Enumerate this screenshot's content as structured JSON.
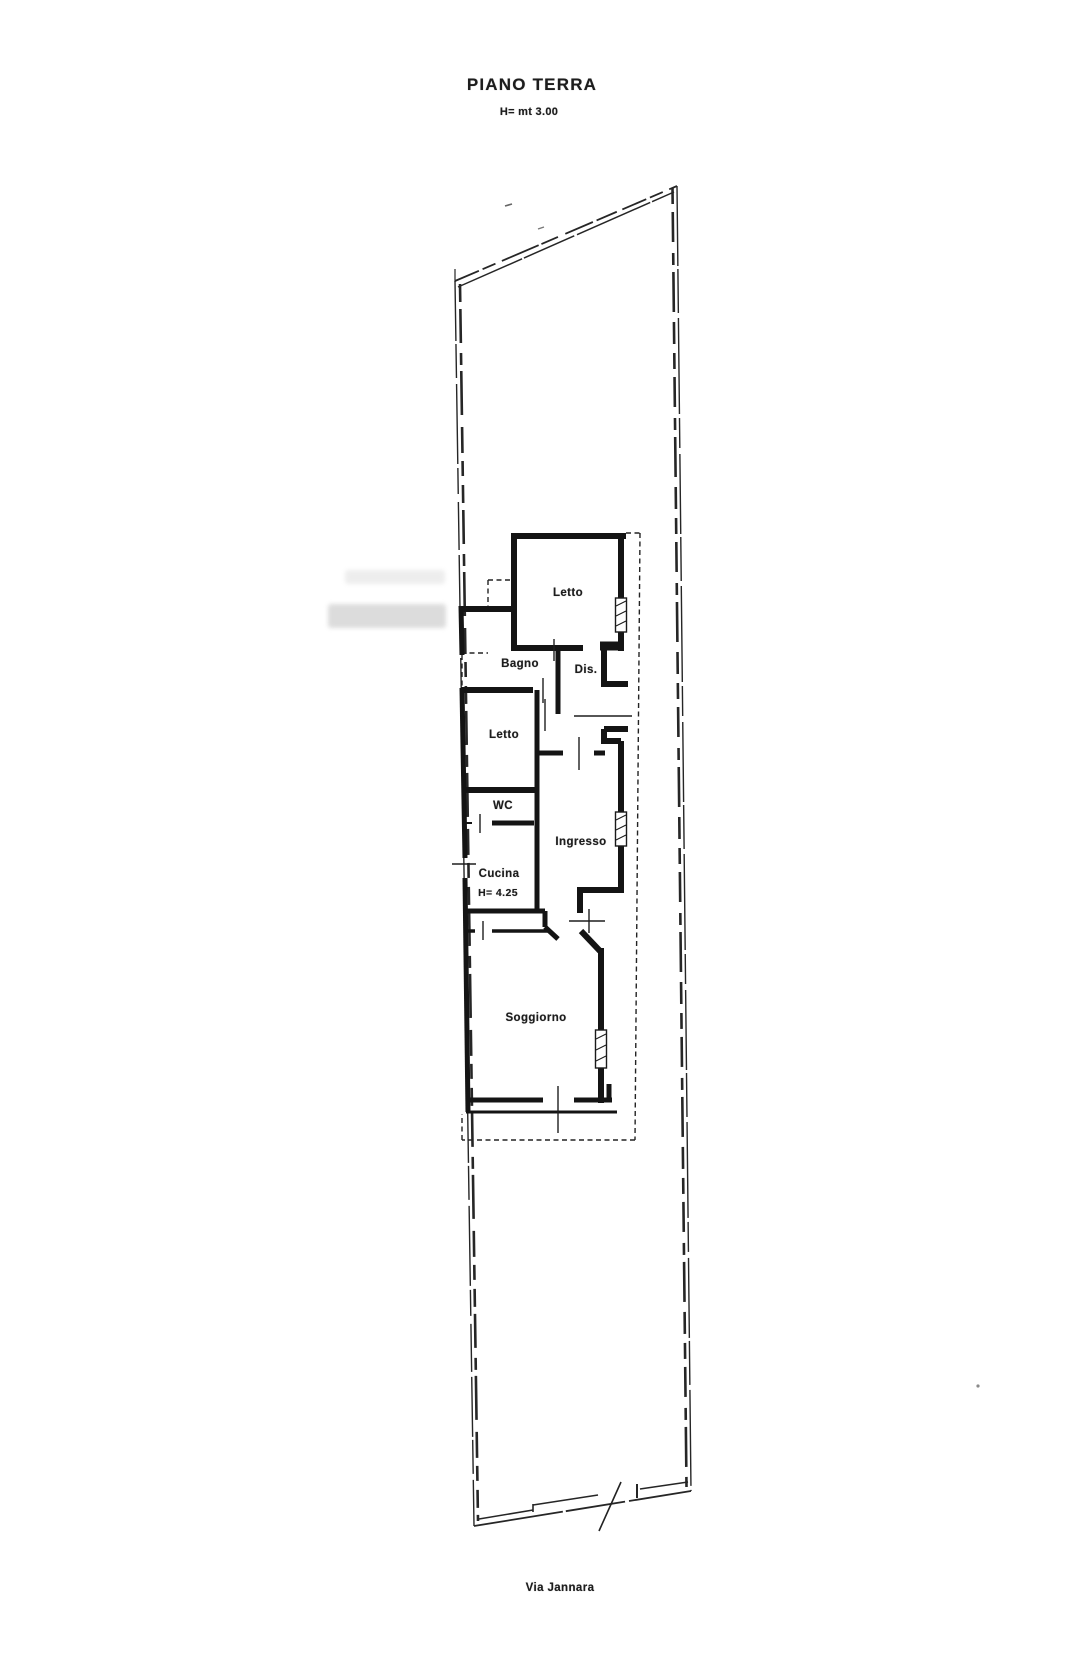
{
  "title_block": {
    "title": "PIANO TERRA",
    "height_note": "H= mt 3.00"
  },
  "rooms": [
    {
      "id": "letto-1",
      "label": "Letto"
    },
    {
      "id": "bagno",
      "label": "Bagno"
    },
    {
      "id": "dis",
      "label": "Dis."
    },
    {
      "id": "letto-2",
      "label": "Letto"
    },
    {
      "id": "wc",
      "label": "WC"
    },
    {
      "id": "ingresso",
      "label": "Ingresso"
    },
    {
      "id": "cucina",
      "label": "Cucina",
      "height_note": "H= 4.25"
    },
    {
      "id": "soggiorno",
      "label": "Soggiorno"
    }
  ],
  "street_label": "Via Jannara",
  "colors": {
    "ink": "#1c1c1c",
    "paper": "#ffffff"
  }
}
